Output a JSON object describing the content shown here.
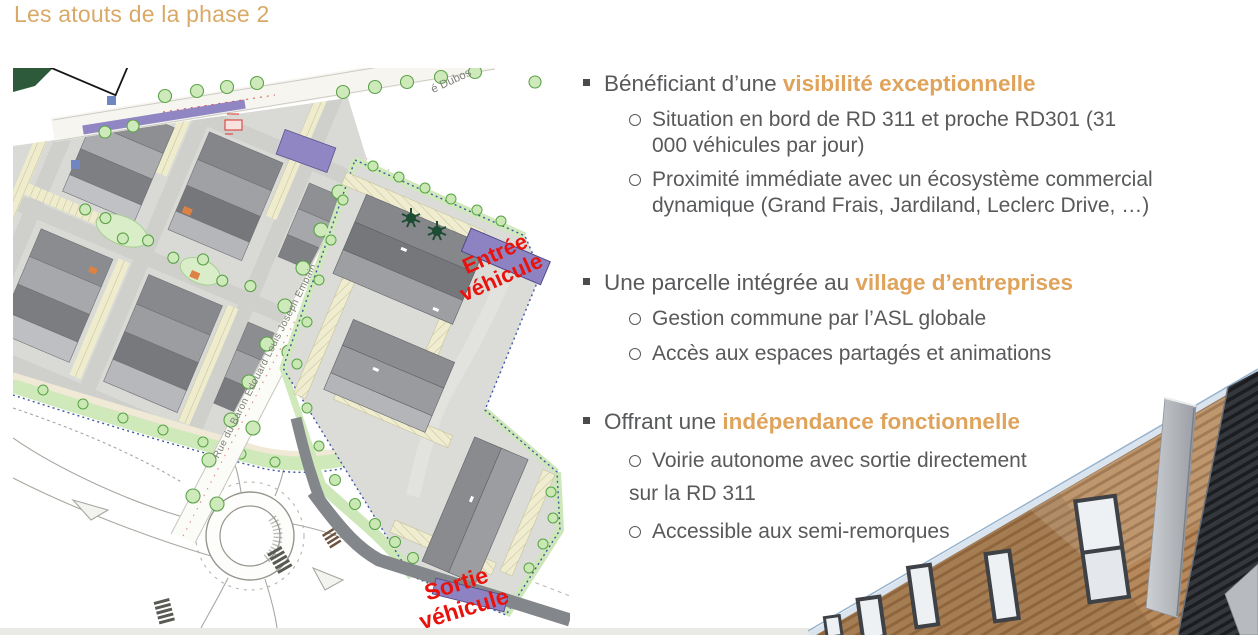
{
  "slide": {
    "title": "Les atouts de la phase 2"
  },
  "colors": {
    "accent": "#DFA35C",
    "title": "#D9A967",
    "body_text": "#58595B",
    "map_label_red": "#E9130D",
    "entrance_purple": "#8D83C3"
  },
  "bullets": [
    {
      "lead": "Bénéficiant d’une ",
      "highlight": "visibilité exceptionnelle",
      "subs": [
        "Situation en bord de RD 311 et proche RD301 (31\n000 véhicules par jour)",
        "Proximité immédiate avec un écosystème commercial\ndynamique (Grand Frais, Jardiland, Leclerc Drive, …)"
      ]
    },
    {
      "lead": "Une parcelle intégrée au ",
      "highlight": "village d’entreprises",
      "subs": [
        "Gestion commune par l’ASL globale",
        "Accès aux espaces partagés et animations"
      ]
    },
    {
      "lead": "Offrant une ",
      "highlight": "indépendance fonctionnelle",
      "subs": [
        "Voirie autonome avec sortie directement\nsur la RD 311",
        "Accessible aux semi-remorques"
      ]
    }
  ],
  "map": {
    "entree_line1": "Entrée",
    "entree_line2": "véhicule",
    "sortie_line1": "Sortie",
    "sortie_line2": "véhicule",
    "street_main": "Rue du Baron Edouard Louis Joseph Empain",
    "street_top": "é Dubos"
  }
}
